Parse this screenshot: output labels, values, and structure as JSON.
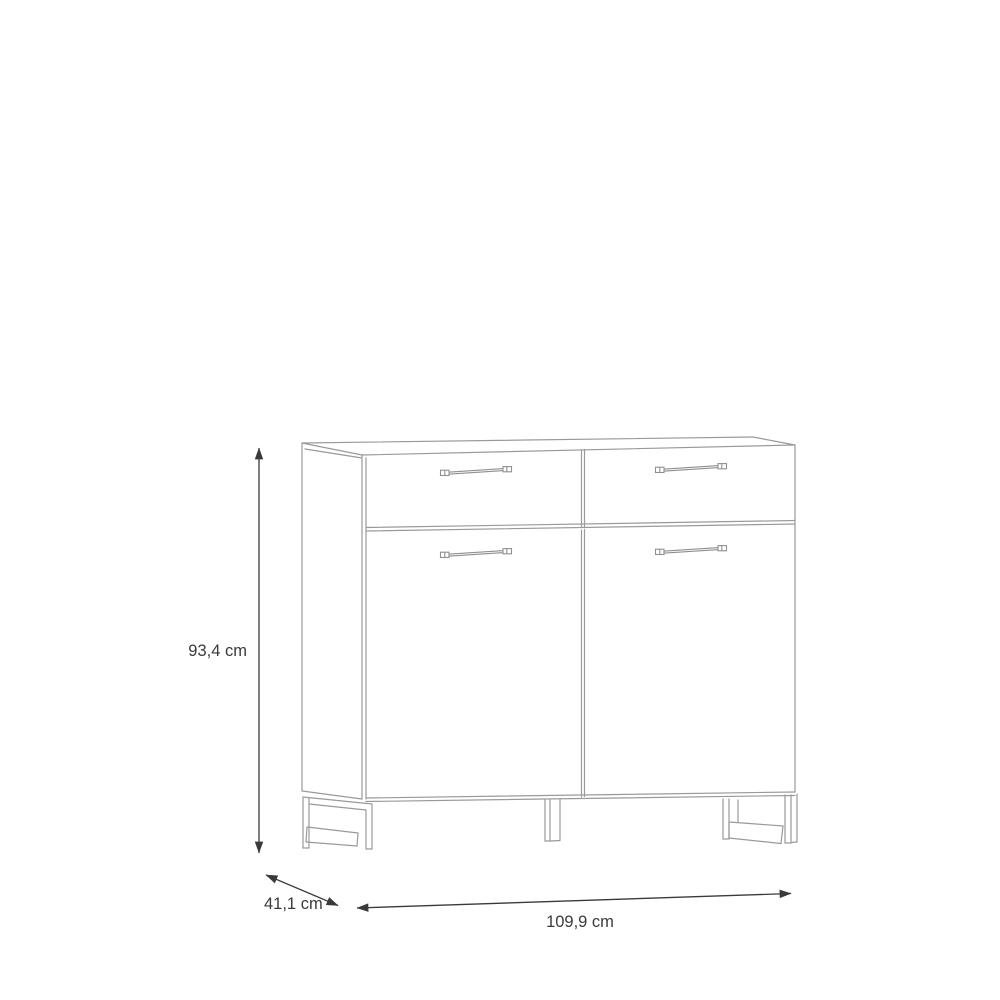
{
  "diagram": {
    "type": "furniture-dimension-drawing",
    "dimensions": {
      "height_label": "93,4 cm",
      "depth_label": "41,1 cm",
      "width_label": "109,9 cm"
    },
    "furniture": {
      "drawer_count": 2,
      "door_count": 2,
      "handle_count": 4,
      "leg_count": 3
    },
    "colors": {
      "background": "#ffffff",
      "furniture_line": "#9a9a9a",
      "dimension_line": "#3a3a3a",
      "label_text": "#3a3a3a"
    }
  }
}
